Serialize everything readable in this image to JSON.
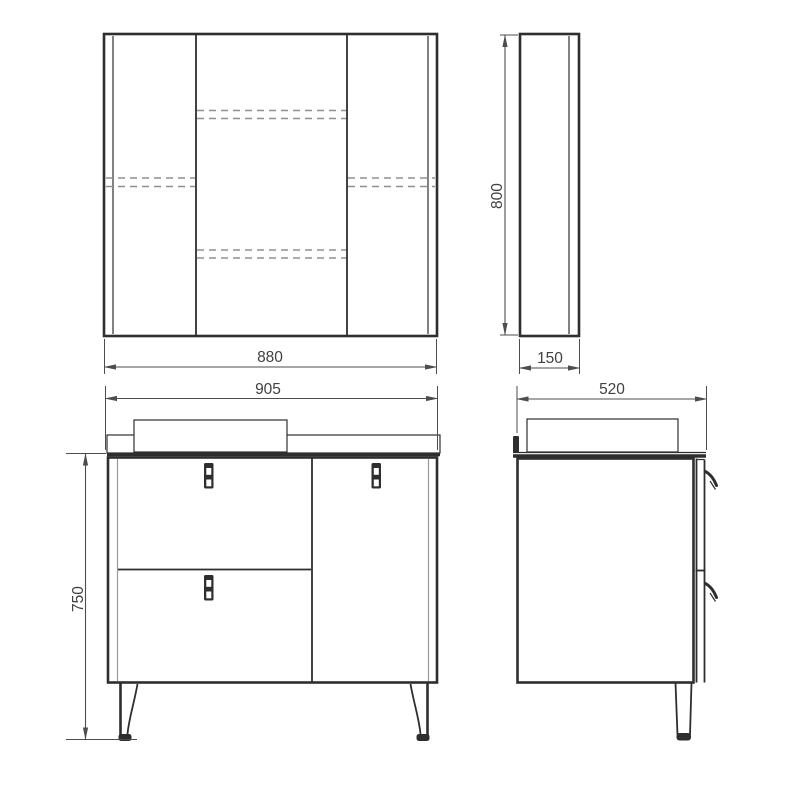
{
  "drawing_title": "vanity-and-mirror-cabinet-dimension-drawing",
  "views": {
    "mirror_front": {
      "label_width": "880"
    },
    "mirror_side": {
      "label_height": "800",
      "label_depth": "150"
    },
    "vanity_front": {
      "label_width": "905",
      "label_height": "750"
    },
    "vanity_side": {
      "label_depth": "520"
    }
  },
  "colors": {
    "line": "#2e2e2e",
    "line_light": "#9a9a9a",
    "dashed_line": "#8f8f8f",
    "dimension": "#4d4d4d",
    "text": "#414141",
    "background": "#ffffff"
  }
}
